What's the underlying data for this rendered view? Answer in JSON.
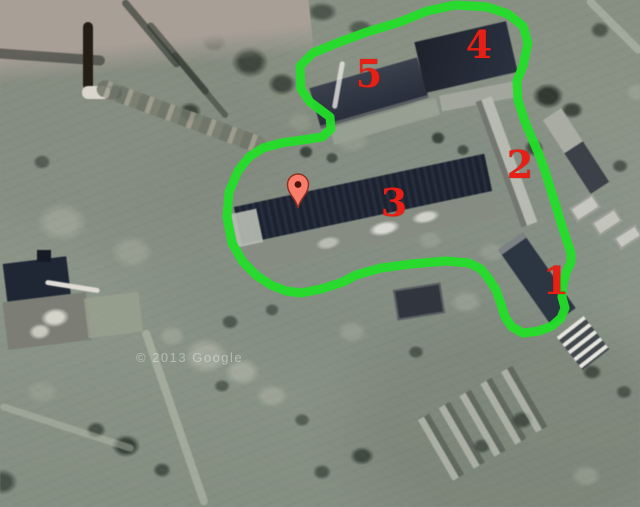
{
  "map": {
    "view_type": "satellite-imagery",
    "watermark": "© 2013 Google",
    "annotation_colors": {
      "outline": "#23de28",
      "labels": "#e62015",
      "pin_fill": "#f97d6b",
      "pin_border": "#8e2f1f",
      "pin_dot": "#4a160c"
    },
    "building_labels": [
      {
        "text": "1",
        "x": 556,
        "y": 281
      },
      {
        "text": "2",
        "x": 520,
        "y": 165
      },
      {
        "text": "3",
        "x": 394,
        "y": 203
      },
      {
        "text": "4",
        "x": 479,
        "y": 45
      },
      {
        "text": "5",
        "x": 369,
        "y": 74
      }
    ],
    "pin": {
      "x": 298,
      "y": 208
    }
  }
}
